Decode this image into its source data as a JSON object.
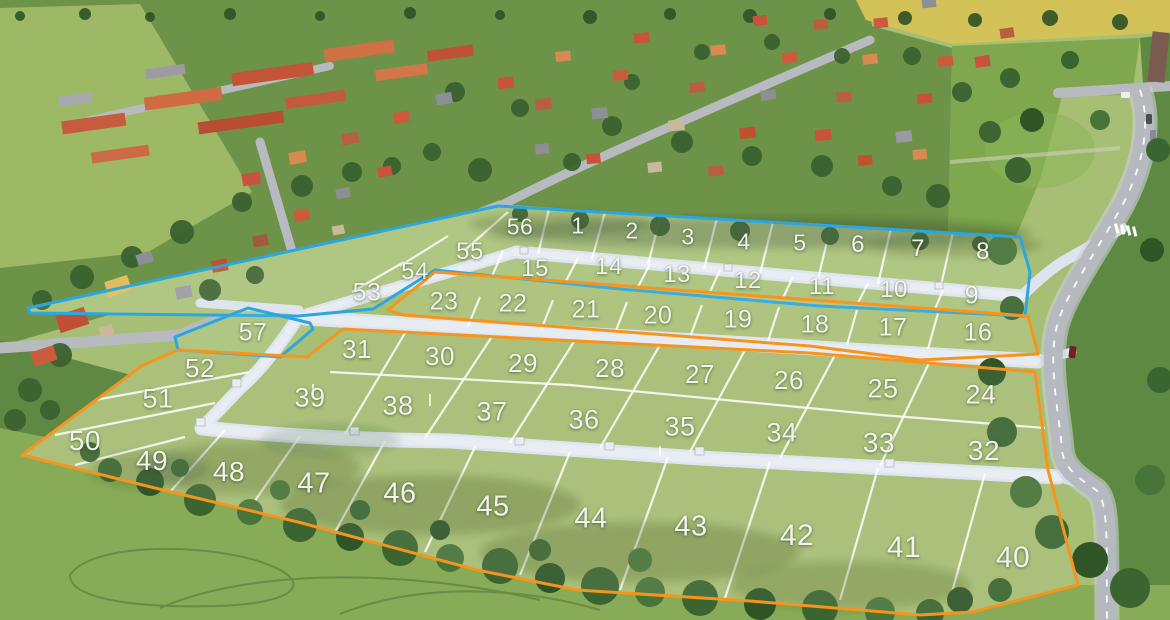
{
  "map": {
    "description": "Aerial development plan with numbered building plots",
    "palette": {
      "zone_blue": "#2AA7E0",
      "zone_orange": "#F7941D",
      "label": "#FAFCF7"
    },
    "zones": [
      {
        "id": "zone-blue-main",
        "color": "#2AA7E0",
        "points": "28,308 498,206 1020,237 1030,272 1025,316 820,306 620,289 435,270 373,309 298,316 30,313"
      },
      {
        "id": "zone-blue-plot57",
        "color": "#2AA7E0",
        "points": "175,337 248,308 310,323 313,329 280,357 178,350"
      },
      {
        "id": "zone-orange-band",
        "color": "#F7941D",
        "points": "435,272 1028,316 1038,354 920,360 810,346 403,315 388,310"
      },
      {
        "id": "zone-orange-main",
        "color": "#F7941D",
        "points": "22,455 143,365 178,350 307,357 343,329 402,332 810,353 1035,372 1048,470 1078,585 972,612 920,615 750,601 577,590 477,570 298,522 163,490"
      }
    ],
    "plots": [
      {
        "n": "1",
        "x": 578,
        "y": 226
      },
      {
        "n": "2",
        "x": 632,
        "y": 231
      },
      {
        "n": "3",
        "x": 688,
        "y": 237
      },
      {
        "n": "4",
        "x": 744,
        "y": 242
      },
      {
        "n": "5",
        "x": 800,
        "y": 243
      },
      {
        "n": "6",
        "x": 858,
        "y": 245
      },
      {
        "n": "7",
        "x": 918,
        "y": 249
      },
      {
        "n": "8",
        "x": 983,
        "y": 252
      },
      {
        "n": "9",
        "x": 972,
        "y": 296
      },
      {
        "n": "10",
        "x": 894,
        "y": 290
      },
      {
        "n": "11",
        "x": 822,
        "y": 287
      },
      {
        "n": "12",
        "x": 748,
        "y": 281
      },
      {
        "n": "13",
        "x": 677,
        "y": 275
      },
      {
        "n": "14",
        "x": 609,
        "y": 267
      },
      {
        "n": "15",
        "x": 535,
        "y": 269
      },
      {
        "n": "16",
        "x": 978,
        "y": 333
      },
      {
        "n": "17",
        "x": 893,
        "y": 328
      },
      {
        "n": "18",
        "x": 815,
        "y": 325
      },
      {
        "n": "19",
        "x": 738,
        "y": 320
      },
      {
        "n": "20",
        "x": 658,
        "y": 316
      },
      {
        "n": "21",
        "x": 586,
        "y": 310
      },
      {
        "n": "22",
        "x": 513,
        "y": 304
      },
      {
        "n": "23",
        "x": 444,
        "y": 302
      },
      {
        "n": "24",
        "x": 981,
        "y": 395
      },
      {
        "n": "25",
        "x": 883,
        "y": 389
      },
      {
        "n": "26",
        "x": 789,
        "y": 380
      },
      {
        "n": "27",
        "x": 700,
        "y": 374
      },
      {
        "n": "28",
        "x": 610,
        "y": 368
      },
      {
        "n": "29",
        "x": 523,
        "y": 363
      },
      {
        "n": "30",
        "x": 440,
        "y": 356
      },
      {
        "n": "31",
        "x": 357,
        "y": 349
      },
      {
        "n": "32",
        "x": 984,
        "y": 451
      },
      {
        "n": "33",
        "x": 879,
        "y": 443
      },
      {
        "n": "34",
        "x": 782,
        "y": 433
      },
      {
        "n": "35",
        "x": 680,
        "y": 427
      },
      {
        "n": "36",
        "x": 584,
        "y": 420
      },
      {
        "n": "37",
        "x": 492,
        "y": 412
      },
      {
        "n": "38",
        "x": 398,
        "y": 406
      },
      {
        "n": "39",
        "x": 310,
        "y": 398
      },
      {
        "n": "40",
        "x": 1013,
        "y": 558
      },
      {
        "n": "41",
        "x": 904,
        "y": 548
      },
      {
        "n": "42",
        "x": 797,
        "y": 536
      },
      {
        "n": "43",
        "x": 691,
        "y": 527
      },
      {
        "n": "44",
        "x": 591,
        "y": 519
      },
      {
        "n": "45",
        "x": 493,
        "y": 507
      },
      {
        "n": "46",
        "x": 400,
        "y": 494
      },
      {
        "n": "47",
        "x": 314,
        "y": 484
      },
      {
        "n": "48",
        "x": 229,
        "y": 472
      },
      {
        "n": "49",
        "x": 152,
        "y": 461
      },
      {
        "n": "50",
        "x": 85,
        "y": 441
      },
      {
        "n": "51",
        "x": 158,
        "y": 399
      },
      {
        "n": "52",
        "x": 200,
        "y": 368
      },
      {
        "n": "53",
        "x": 367,
        "y": 293
      },
      {
        "n": "54",
        "x": 415,
        "y": 272
      },
      {
        "n": "55",
        "x": 470,
        "y": 252
      },
      {
        "n": "56",
        "x": 520,
        "y": 227
      },
      {
        "n": "57",
        "x": 253,
        "y": 333
      }
    ]
  }
}
